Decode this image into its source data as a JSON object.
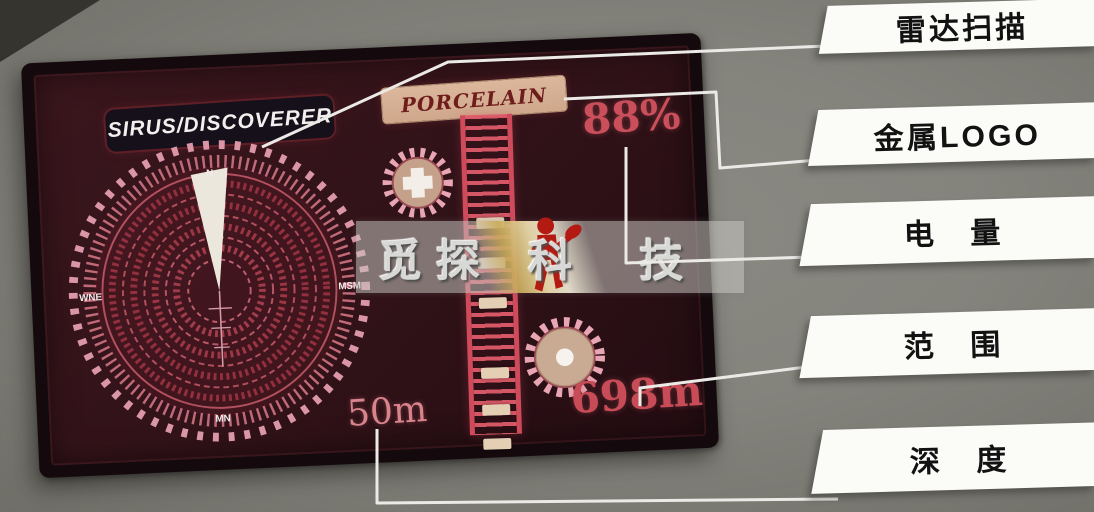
{
  "screen": {
    "device_title": "SIRUS/DISCOVERER",
    "target_label": "PORCELAIN",
    "battery_percent": "88%",
    "depth_value": "50m",
    "range_value": "698m",
    "radar_compass": {
      "top": "N",
      "left": "WNE",
      "right": "MSM",
      "bottom": "MN"
    }
  },
  "watermark": {
    "left_text": "觅探",
    "right_text": "科 技"
  },
  "callouts": [
    {
      "label": "雷达扫描"
    },
    {
      "label": "金属LOGO"
    },
    {
      "label": "电　量"
    },
    {
      "label": "范　围"
    },
    {
      "label": "深　度"
    }
  ],
  "colors": {
    "accent_red": "#c84c58",
    "radar_pink": "#d893a2",
    "screen_bg": "#301218",
    "label_bg": "#fbfbf8",
    "plate_tan": "#d5b296",
    "figure_red": "#b31a12"
  }
}
